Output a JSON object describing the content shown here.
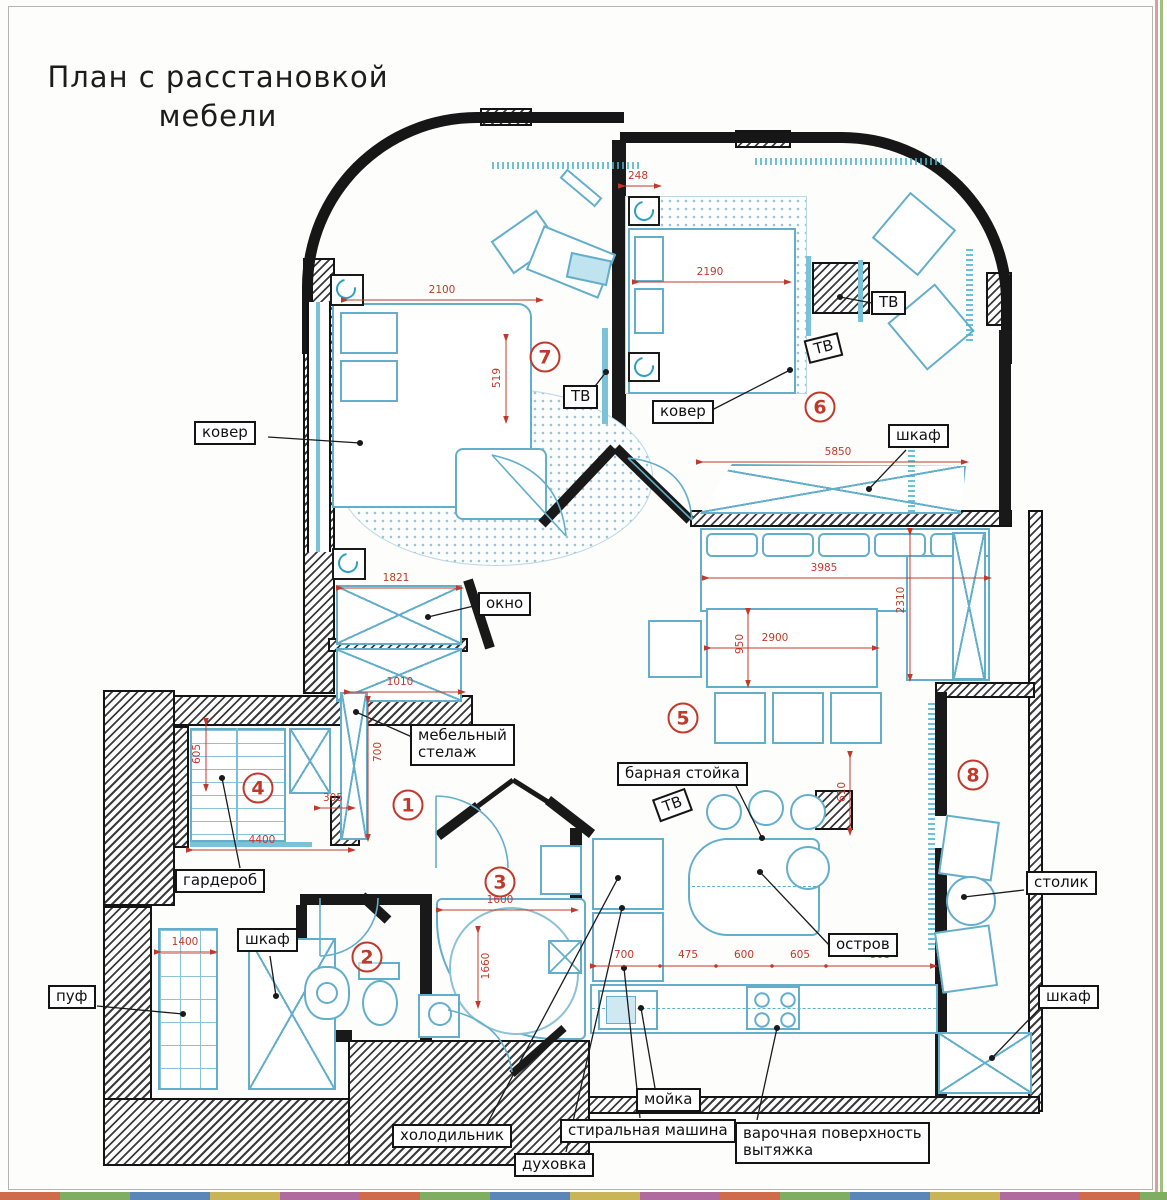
{
  "title": {
    "line1": "План с расстановкой",
    "line2": "мебели"
  },
  "colors": {
    "wall": "#191919",
    "furniture": "#63aecb",
    "dimension": "#c0392b",
    "room_number": "#c0392b",
    "label_border": "#141414"
  },
  "room_numbers": [
    {
      "n": "1",
      "x": 408,
      "y": 805
    },
    {
      "n": "2",
      "x": 367,
      "y": 957
    },
    {
      "n": "3",
      "x": 500,
      "y": 882
    },
    {
      "n": "4",
      "x": 258,
      "y": 788
    },
    {
      "n": "5",
      "x": 683,
      "y": 718
    },
    {
      "n": "6",
      "x": 820,
      "y": 407
    },
    {
      "n": "7",
      "x": 545,
      "y": 357
    },
    {
      "n": "8",
      "x": 973,
      "y": 775
    }
  ],
  "labels": [
    {
      "id": "kover-left",
      "text": "ковер",
      "x": 194,
      "y": 421,
      "rot": 0
    },
    {
      "id": "tv-room7",
      "text": "ТВ",
      "x": 563,
      "y": 385,
      "rot": 0
    },
    {
      "id": "kover-room6",
      "text": "ковер",
      "x": 652,
      "y": 400,
      "rot": 0
    },
    {
      "id": "tv-room6",
      "text": "ТВ",
      "x": 871,
      "y": 291,
      "rot": 0
    },
    {
      "id": "tv-room6-wall",
      "text": "ТВ",
      "x": 806,
      "y": 336,
      "rot": -14
    },
    {
      "id": "shkaf-top",
      "text": "шкаф",
      "x": 888,
      "y": 424,
      "rot": 0
    },
    {
      "id": "okno",
      "text": "окно",
      "x": 478,
      "y": 592,
      "rot": 0
    },
    {
      "id": "stellazh",
      "text": "мебельный\nстелаж",
      "x": 410,
      "y": 724,
      "rot": 0
    },
    {
      "id": "garderob",
      "text": "гардероб",
      "x": 175,
      "y": 869,
      "rot": 0
    },
    {
      "id": "shkaf-hall",
      "text": "шкаф",
      "x": 237,
      "y": 928,
      "rot": 0
    },
    {
      "id": "puf",
      "text": "пуф",
      "x": 48,
      "y": 985,
      "rot": 0
    },
    {
      "id": "bar-stoyka",
      "text": "барная стойка",
      "x": 617,
      "y": 762,
      "rot": 0
    },
    {
      "id": "tv-bar",
      "text": "ТВ",
      "x": 655,
      "y": 793,
      "rot": -20
    },
    {
      "id": "ostrov",
      "text": "остров",
      "x": 828,
      "y": 933,
      "rot": 0
    },
    {
      "id": "stolik",
      "text": "столик",
      "x": 1026,
      "y": 871,
      "rot": 0
    },
    {
      "id": "shkaf-room8",
      "text": "шкаф",
      "x": 1038,
      "y": 985,
      "rot": 0
    },
    {
      "id": "moika",
      "text": "мойка",
      "x": 636,
      "y": 1088,
      "rot": 0
    },
    {
      "id": "kholodilnik",
      "text": "холодильник",
      "x": 392,
      "y": 1124,
      "rot": 0
    },
    {
      "id": "dukhovka",
      "text": "духовка",
      "x": 514,
      "y": 1153,
      "rot": 0
    },
    {
      "id": "stiralnaya",
      "text": "стиральная машина",
      "x": 560,
      "y": 1119,
      "rot": 0
    },
    {
      "id": "varochnaya",
      "text": "варочная поверхность\nвытяжка",
      "x": 735,
      "y": 1122,
      "rot": 0
    }
  ],
  "dimensions": [
    {
      "t": "2100",
      "x": 442,
      "y": 290,
      "rot": 0
    },
    {
      "t": "248",
      "x": 638,
      "y": 176,
      "rot": 0
    },
    {
      "t": "2190",
      "x": 710,
      "y": 272,
      "rot": 0
    },
    {
      "t": "519",
      "x": 497,
      "y": 378,
      "rot": 90
    },
    {
      "t": "5850",
      "x": 838,
      "y": 452,
      "rot": 0
    },
    {
      "t": "3985",
      "x": 824,
      "y": 568,
      "rot": 0
    },
    {
      "t": "2310",
      "x": 901,
      "y": 600,
      "rot": 90
    },
    {
      "t": "2900",
      "x": 775,
      "y": 638,
      "rot": 0
    },
    {
      "t": "950",
      "x": 740,
      "y": 644,
      "rot": 90
    },
    {
      "t": "1821",
      "x": 396,
      "y": 578,
      "rot": 0
    },
    {
      "t": "1010",
      "x": 400,
      "y": 682,
      "rot": 0
    },
    {
      "t": "700",
      "x": 378,
      "y": 752,
      "rot": 90
    },
    {
      "t": "605",
      "x": 197,
      "y": 754,
      "rot": 90
    },
    {
      "t": "305",
      "x": 333,
      "y": 798,
      "rot": 0
    },
    {
      "t": "4400",
      "x": 262,
      "y": 840,
      "rot": 0
    },
    {
      "t": "1400",
      "x": 185,
      "y": 942,
      "rot": 0
    },
    {
      "t": "1600",
      "x": 500,
      "y": 900,
      "rot": 0
    },
    {
      "t": "1660",
      "x": 486,
      "y": 966,
      "rot": 90
    },
    {
      "t": "610",
      "x": 842,
      "y": 792,
      "rot": 90
    },
    {
      "t": "700",
      "x": 624,
      "y": 955,
      "rot": 0
    },
    {
      "t": "475",
      "x": 688,
      "y": 955,
      "rot": 0
    },
    {
      "t": "600",
      "x": 744,
      "y": 955,
      "rot": 0
    },
    {
      "t": "605",
      "x": 800,
      "y": 955,
      "rot": 0
    },
    {
      "t": "908",
      "x": 880,
      "y": 955,
      "rot": 0
    }
  ]
}
